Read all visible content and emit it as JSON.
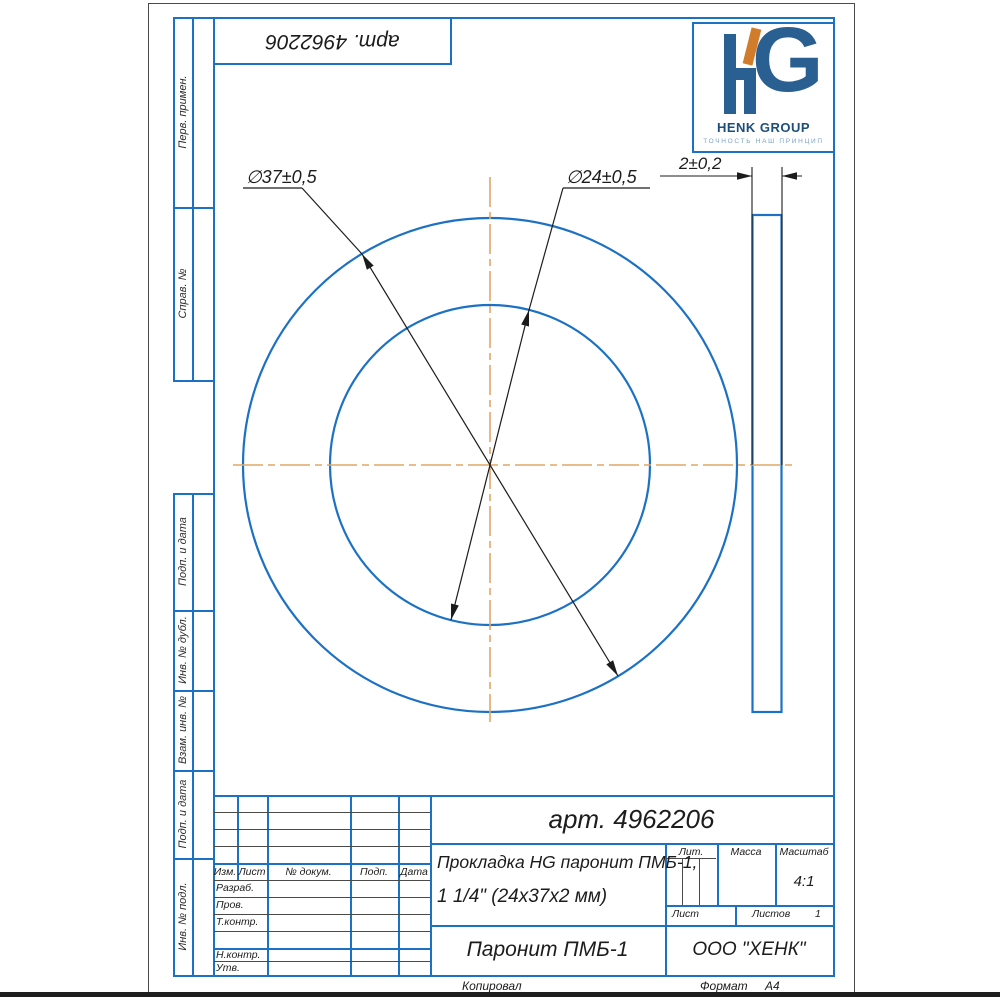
{
  "colors": {
    "frame_blue": "#1d71c4",
    "thin_line_dark": "#4a4a4a",
    "centerline_orange": "#e0a766",
    "dimension_black": "#1c1c1c",
    "logo_blue": "#2a5f91",
    "logo_dark_blue": "#1d4e7a",
    "logo_orange": "#d07c2a",
    "logo_light_blue": "#7ba3c4"
  },
  "stamp_top": {
    "article_rotated": "арт. 4962206"
  },
  "logo": {
    "name": "HENK GROUP",
    "tagline": "ТОЧНОСТЬ НАШ ПРИНЦИП"
  },
  "left_strip": {
    "labels": [
      "Перв. примен.",
      "Справ. №",
      "Подп. и дата",
      "Инв. № дубл.",
      "Взам. инв. №",
      "Подп. и дата",
      "Инв. № подл."
    ]
  },
  "drawing": {
    "dim_outer_diameter": "∅37±0,5",
    "dim_inner_diameter": "∅24±0,5",
    "dim_thickness": "2±0,2"
  },
  "title_block": {
    "article": "арт. 4962206",
    "name_line1": "Прокладка HG паронит ПМБ-1,",
    "name_line2": "1 1/4\" (24х37х2 мм)",
    "material": "Паронит ПМБ-1",
    "company": "ООО \"ХЕНК\"",
    "col_izm": "Изм.",
    "col_list": "Лист",
    "col_doc": "№ докум.",
    "col_podp": "Подп.",
    "col_data": "Дата",
    "row_razrab": "Разраб.",
    "row_prov": "Пров.",
    "row_tkontr": "Т.контр.",
    "row_nkontr": "Н.контр.",
    "row_utv": "Утв.",
    "lit": "Лит.",
    "massa": "Масса",
    "masshtab": "Масштаб",
    "scale": "4:1",
    "list": "Лист",
    "listov": "Листов",
    "listov_value": "1",
    "footer_copy": "Копировал",
    "footer_format": "Формат",
    "format_value": "А4"
  }
}
